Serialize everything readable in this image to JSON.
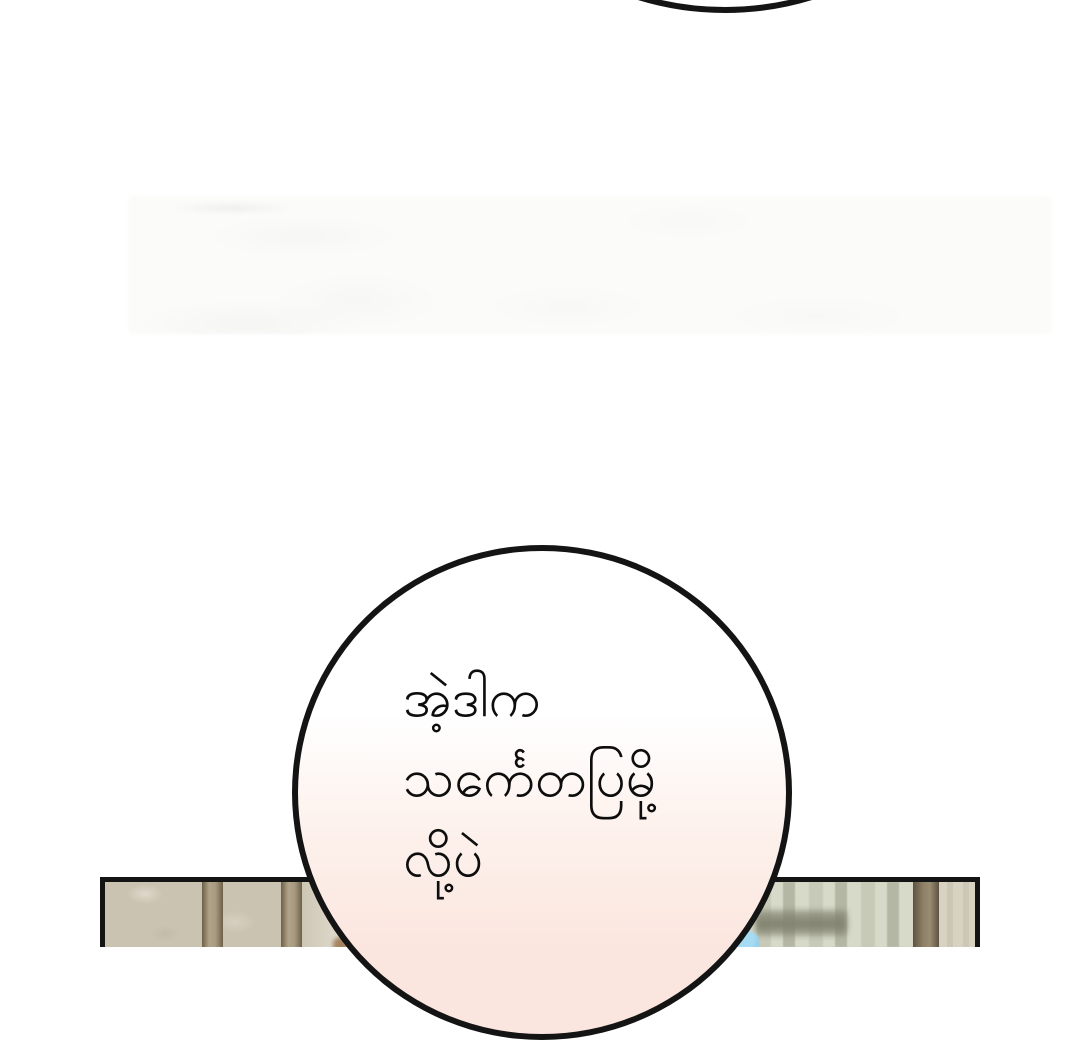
{
  "bubble": {
    "lines": [
      "အဲ့ဒါက",
      "သင်္ကေတပြမို့",
      "လို့ပဲ"
    ],
    "full_text": "အဲ့ဒါက သင်္ကေတပြမို့ လို့ပဲ"
  },
  "colors": {
    "page_bg": "#ffffff",
    "ink": "#141414",
    "text": "#0d0d0d",
    "bubble_fill_top": "#ffffff",
    "bubble_fill_mid": "#fdf1ec",
    "bubble_fill_bottom": "#fbe6df",
    "ghost_panel": "#fbfbf9",
    "wallpaper": "#cac3b1",
    "wallpaper_light": "#e9e4d9",
    "pillar_mid": "#b2a489",
    "pillar_edge": "#6d6049",
    "curtain_a": "#c8cab8",
    "curtain_b": "#b5b7a5",
    "curtain_c": "#d7d9c9",
    "shelf_shadow": "#80816e",
    "right_pillar_mid": "#8f8168",
    "right_pillar_edge": "#5e5340",
    "right_wall": "#d7d2c1",
    "blue_object": "#a6dbf4",
    "blue_object_edge": "#86c3e2"
  }
}
